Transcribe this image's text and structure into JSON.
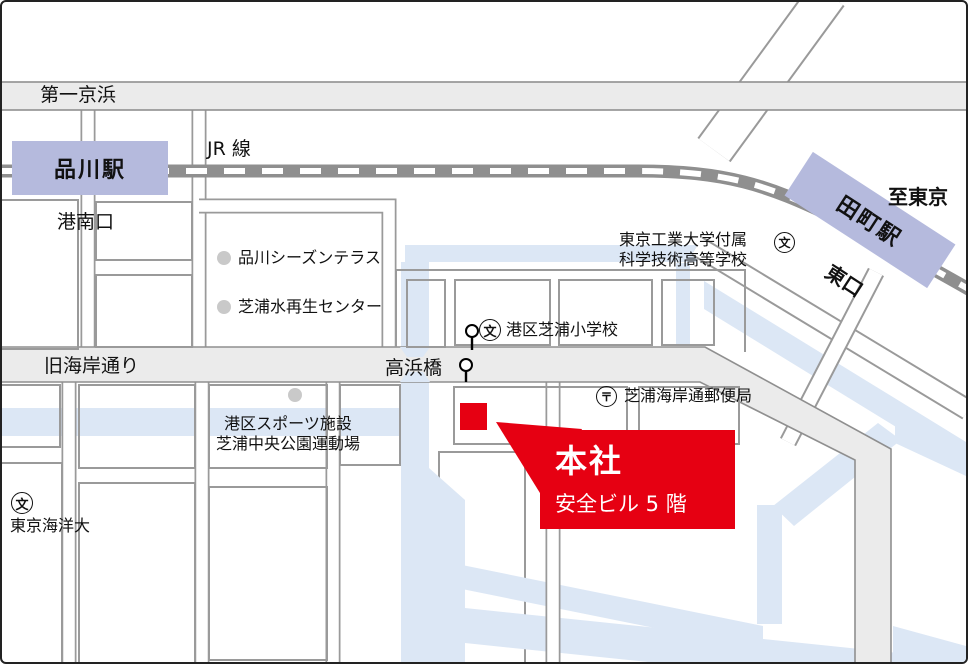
{
  "map": {
    "roads": {
      "daiichi_keihin": "第一京浜",
      "kyukaigan": "旧海岸通り",
      "jr_line": "JR 線",
      "takahama_bashi": "高浜橋"
    },
    "stations": {
      "shinagawa": "品川駅",
      "tamachi": "田町駅",
      "konan_exit": "港南口",
      "east_exit": "東口",
      "to_tokyo": "至東京"
    },
    "landmarks": {
      "season_terrace": "品川シーズンテラス",
      "water_center": "芝浦水再生センター",
      "tech_hs_line1": "東京工業大学付属",
      "tech_hs_line2": "科学技術高等学校",
      "elementary": "港区芝浦小学校",
      "post_office": "芝浦海岸通郵便局",
      "sports_line1": "港区スポーツ施設",
      "sports_line2": "芝浦中央公園運動場",
      "marine_univ": "東京海洋大"
    },
    "symbols": {
      "school": "文",
      "post": "〒"
    },
    "callout": {
      "title": "本社",
      "subtitle": "安全ビル 5 階"
    },
    "colors": {
      "accent_red": "#e60012",
      "station": "#b5badd",
      "canal": "#dce7f5",
      "road_fill": "#ebebeb",
      "road_border": "#8f8f8f",
      "rail": "#8f8f8f"
    }
  }
}
